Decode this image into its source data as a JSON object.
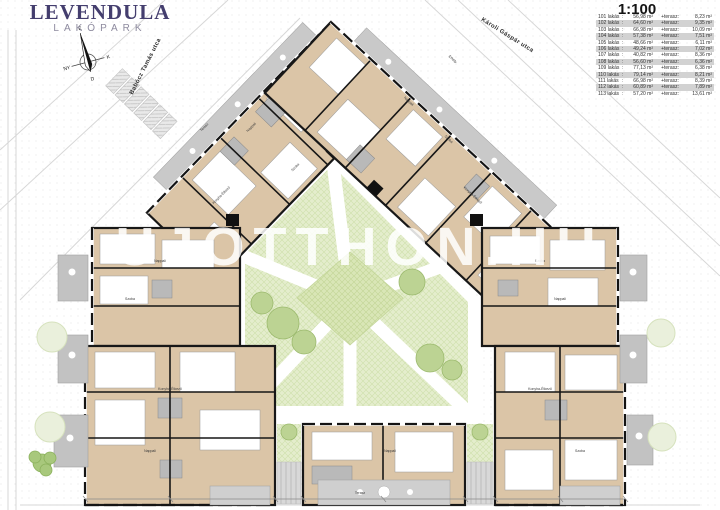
{
  "logo": {
    "title": "LEVENDULA",
    "subtitle": "LAKÓPARK"
  },
  "scale_label": "1:100",
  "watermark": "UJOTTHON.HU",
  "streets": {
    "left": "Babócz Tamás utca",
    "right": "Károli Gáspár utca"
  },
  "compass": {
    "n": "É",
    "s": "D",
    "e": "K",
    "w": "NY"
  },
  "legend_sep": ":",
  "legend_terasz_label": "+terasz:",
  "legend_rows": [
    {
      "unit": "101 lakás",
      "area": "56,98 m²",
      "terasz": "8,23 m²"
    },
    {
      "unit": "102 lakás",
      "area": "64,60 m²",
      "terasz": "9,35 m²"
    },
    {
      "unit": "103 lakás",
      "area": "66,98 m²",
      "terasz": "10,09 m²"
    },
    {
      "unit": "104 lakás",
      "area": "57,38 m²",
      "terasz": "7,51 m²"
    },
    {
      "unit": "105 lakás",
      "area": "48,66 m²",
      "terasz": "6,11 m²"
    },
    {
      "unit": "106 lakás",
      "area": "49,24 m²",
      "terasz": "7,02 m²"
    },
    {
      "unit": "107 lakás",
      "area": "40,82 m²",
      "terasz": "8,36 m²"
    },
    {
      "unit": "108 lakás",
      "area": "56,60 m²",
      "terasz": "6,36 m²"
    },
    {
      "unit": "109 lakás",
      "area": "77,13 m²",
      "terasz": "6,38 m²"
    },
    {
      "unit": "110 lakás",
      "area": "79,14 m²",
      "terasz": "8,21 m²"
    },
    {
      "unit": "111 lakás",
      "area": "66,98 m²",
      "terasz": "8,39 m²"
    },
    {
      "unit": "112 lakás",
      "area": "60,89 m²",
      "terasz": "7,89 m²"
    },
    {
      "unit": "113 lakás",
      "area": "57,20 m²",
      "terasz": "13,61 m²"
    }
  ],
  "plan": {
    "room_labels": [
      "Nappali",
      "Szoba",
      "Konyha-Étkező",
      "Terasz",
      "Nappali",
      "Szoba",
      "Konyha-Étkező",
      "Erkély",
      "Nappali",
      "Szoba",
      "Konyha-Étkező",
      "Nappali",
      "Szoba",
      "Nappali",
      "Konyha-Étkező",
      "Szoba",
      "Nappali",
      "Terasz"
    ]
  }
}
